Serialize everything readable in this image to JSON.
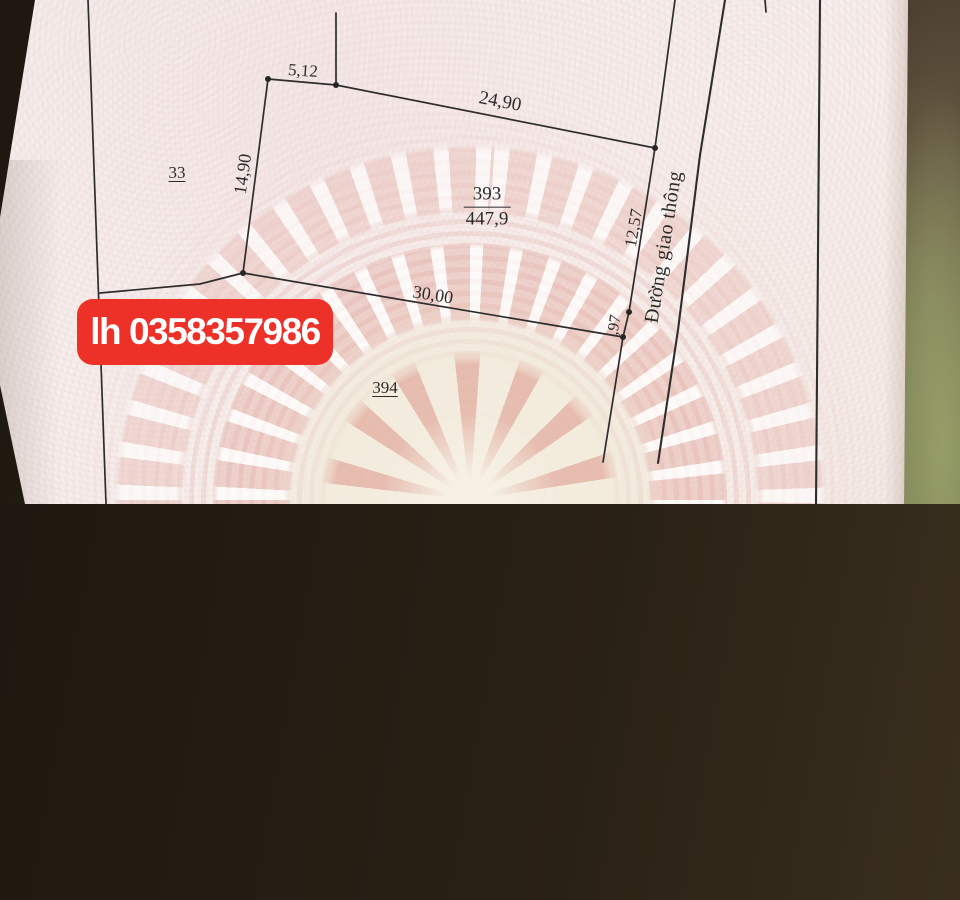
{
  "badge": {
    "text": "lh 0358357986",
    "background_color": "#ee3128",
    "text_color": "#ffffff"
  },
  "road": {
    "label": "Đường giao thông"
  },
  "parcels": {
    "parcel_left": "33",
    "parcel_bottom": "394",
    "parcel_main": {
      "number": "393",
      "area": "447,9"
    }
  },
  "dimensions": {
    "top_left": "5,12",
    "top": "24,90",
    "left": "14,90",
    "right_upper": "12,57",
    "right_lower": ",97",
    "bottom": "30,00"
  },
  "colors": {
    "paper": "#f5efec",
    "watermark_pink": "#e7b9af",
    "map_line": "#2d2d2d",
    "badge_red": "#ee3128",
    "table_brown": "#4a3b28",
    "table_olive": "#6f7351"
  }
}
